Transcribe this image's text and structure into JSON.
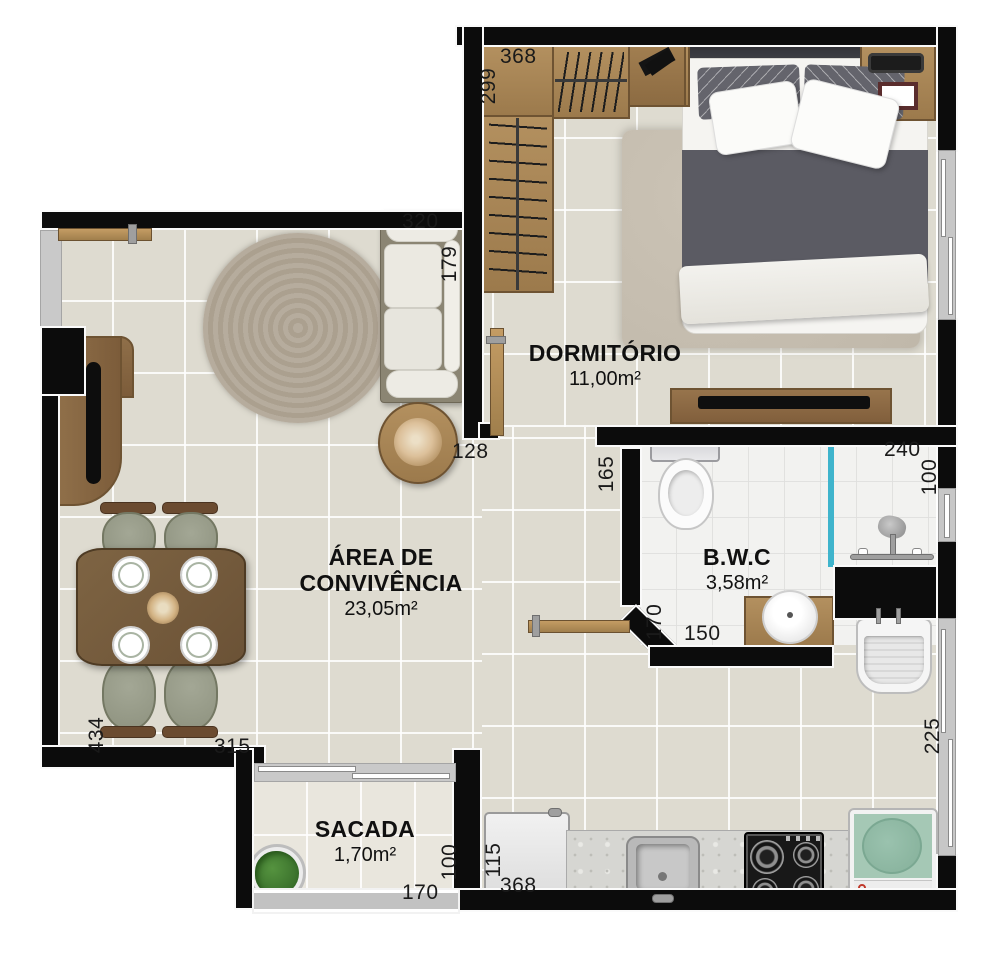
{
  "plan_title": "apartment-floor-plan",
  "rooms": {
    "dormitorio": {
      "name": "DORMITÓRIO",
      "area": "11,00m²"
    },
    "convivencia": {
      "name": "ÁREA DE CONVIVÊNCIA",
      "area": "23,05m²"
    },
    "bwc": {
      "name": "B.W.C",
      "area": "3,58m²"
    },
    "sacada": {
      "name": "SACADA",
      "area": "1,70m²"
    }
  },
  "dimensions": {
    "closet_w": "368",
    "closet_d": "299",
    "sofa_w": "320",
    "sofa_d": "179",
    "hall_w": "128",
    "hall_d": "165",
    "shower_w": "240",
    "shower_d": "100",
    "bwc_door": "170",
    "bwc_w": "150",
    "living_d": "434",
    "living_w": "315",
    "sacada_d": "100",
    "sacada_w": "170",
    "fridge_d": "115",
    "kitchen_w": "368",
    "service_d": "225"
  },
  "colors": {
    "wall": "#0c0c0c",
    "floor": "#dedbd0",
    "bathroom_floor": "#f2f2f0",
    "wood": "#a9885c",
    "shower_glass": "#3fb4cc",
    "washer_green": "#a5c8b5",
    "label_text": "#1a1a1a"
  }
}
